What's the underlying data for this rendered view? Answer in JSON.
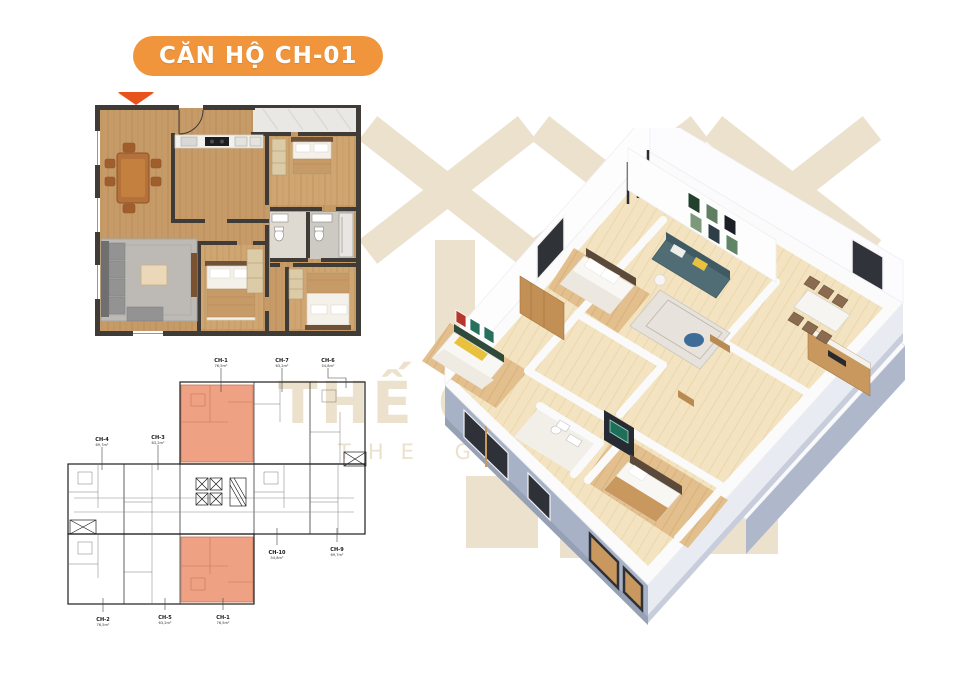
{
  "badge": {
    "label": "CĂN HỘ CH-01"
  },
  "watermark": {
    "brand_vi": "THẾ GIỚI NHÀ",
    "brand_en": "THE GLOBAL HOUSE",
    "color": "#EBE1CC"
  },
  "colors": {
    "badge_bg": "#F0953C",
    "badge_text": "#FFFFFF",
    "pointer": "#E8521D",
    "keyplan_highlight": "#EFA184",
    "plan_wall": "#3F3B37",
    "plan_floor_wood": "#C69B67",
    "render_exterior_wall": "#A8B2C6",
    "render_sofa": "#506D76",
    "watermark": "#EBE1CC"
  },
  "keyplan": {
    "labels": [
      {
        "code": "CH-1",
        "area": "76,5m²"
      },
      {
        "code": "CH-7",
        "area": "63,2m²"
      },
      {
        "code": "CH-6",
        "area": "54,8m²"
      },
      {
        "code": "CH-4",
        "area": "69,7m²"
      },
      {
        "code": "CH-3",
        "area": "63,2m²"
      },
      {
        "code": "CH-10",
        "area": "54,8m²"
      },
      {
        "code": "CH-9",
        "area": "69,7m²"
      },
      {
        "code": "CH-2",
        "area": "76,5m²"
      },
      {
        "code": "CH-5",
        "area": "63,2m²"
      },
      {
        "code": "CH-1",
        "area": "76,5m²"
      }
    ]
  }
}
